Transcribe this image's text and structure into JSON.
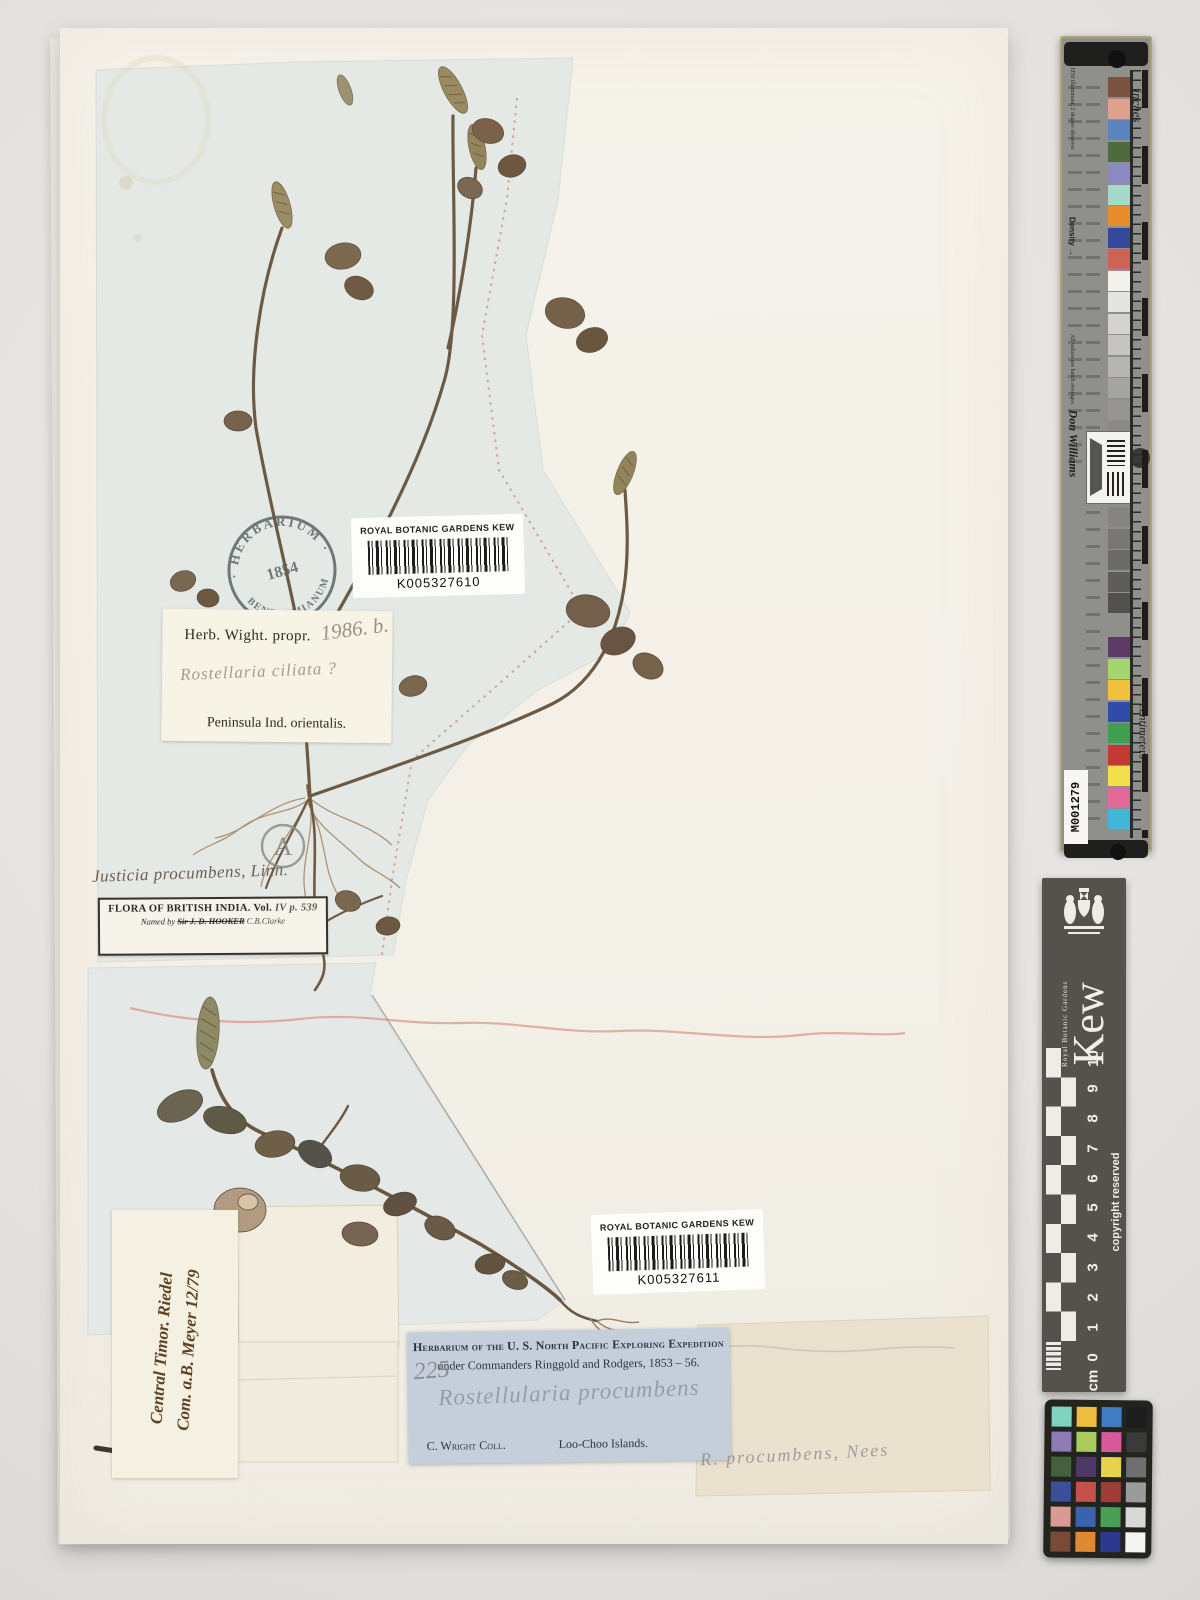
{
  "sheet": {
    "stamp": {
      "top": "· HERBARIUM ·",
      "year": "1854",
      "bottom": "BENTHAMIANUM"
    },
    "barcode_top": {
      "title": "ROYAL BOTANIC GARDENS KEW",
      "code": "K005327610"
    },
    "barcode_bottom": {
      "title": "ROYAL BOTANIC GARDENS KEW",
      "code": "K005327611"
    },
    "wight_label": {
      "title": "Herb. Wight. propr.",
      "hw_number": "1986. b.",
      "hw_species": "Rostellaria ciliata ?",
      "locality": "Peninsula Ind. orientalis."
    },
    "determination": "Justicia procumbens, Linn.",
    "flora_label": {
      "title": "FLORA OF BRITISH INDIA.",
      "vol_printed": "Vol.",
      "vol_hw": "IV p. 539",
      "named_printed": "Named by",
      "named_struck": "Sir J. D. HOOKER",
      "named_hw": "C.B.Clarke"
    },
    "timor_label": {
      "line1": "Central Timor. Riedel",
      "line2": "Com. a.B. Meyer 12/79"
    },
    "expedition_label": {
      "title": "Herbarium of the U. S. North Pacific Exploring Expedition",
      "hw_number": "225",
      "subtitle": "under Commanders Ringgold and Rodgers, 1853 – 56.",
      "hw_species": "Rostellularia procumbens",
      "collector": "C. Wright Coll.",
      "locality": "Loo-Choo Islands."
    },
    "pencil_note": "R. procumbens, Nees",
    "circled_annotation": "A"
  },
  "scale_card": {
    "inches_label": "inches",
    "centimeters_label": "centimeters",
    "density_label": "Density →",
    "illuminant_note": "D50 illuminant, 2 degree observer",
    "values_note": "All values are batch averages",
    "author": "Don Williams",
    "id_code": "M001279",
    "patches_top": [
      "#7a5240",
      "#e0a18c",
      "#5b84c0",
      "#4f6b3d",
      "#8d8ac2",
      "#a5d9cc",
      "#e68e2e",
      "#35489c",
      "#cd6257",
      "#f2f1ec",
      "#e4e4e2",
      "#d4d3d1",
      "#c5c4c2",
      "#b5b4b2",
      "#a5a4a2",
      "#969593",
      "#8a8987"
    ],
    "patches_mid": [
      "#858482",
      "#787776",
      "#6b6a69",
      "#5e5d5c",
      "#525150"
    ],
    "patches_bottom": [
      "#5e3a66",
      "#a6d56f",
      "#f0c23c",
      "#2f4da8",
      "#3f9e4f",
      "#c23a34",
      "#f1e04a",
      "#e0689a",
      "#43b6d8"
    ]
  },
  "kew_ruler": {
    "brand": "Kew",
    "brand_sub": "Royal Botanic Gardens",
    "copyright": "copyright reserved",
    "unit": "cm",
    "numbers": [
      "10",
      "9",
      "8",
      "7",
      "6",
      "5",
      "4",
      "3",
      "2",
      "1",
      "0"
    ]
  },
  "color_checker": {
    "rows": [
      [
        "#7fd4c1",
        "#eebc3e",
        "#3f7cc3",
        "#1d1d1d"
      ],
      [
        "#8e7bb6",
        "#a8cc5a",
        "#d9589a",
        "#3a3a3a"
      ],
      [
        "#44603c",
        "#4e3866",
        "#e8d14c",
        "#6f6f6f"
      ],
      [
        "#3a4f9e",
        "#c6504a",
        "#a03c38",
        "#9b9b9b"
      ],
      [
        "#d99a94",
        "#3a63ad",
        "#4a9e55",
        "#d8d8d6"
      ],
      [
        "#7a4a38",
        "#df8a33",
        "#2b3a8f",
        "#f4f4f0"
      ]
    ]
  }
}
